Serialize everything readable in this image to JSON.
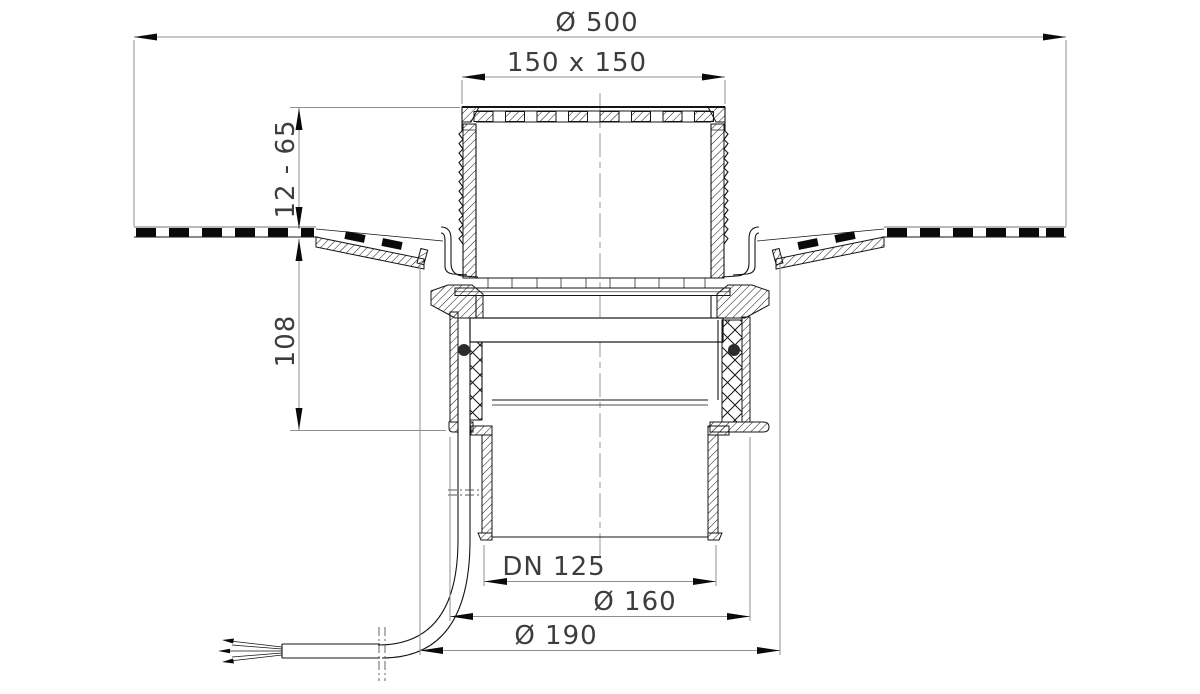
{
  "drawing": {
    "dimensions": {
      "top_diameter": "Ø 500",
      "grate_size": "150 x 150",
      "height_range": "12 - 65",
      "body_height": "108",
      "outlet_nominal": "DN 125",
      "outlet_outer": "Ø 160",
      "flange_diameter": "Ø 190"
    },
    "colors": {
      "line": "#141414",
      "dimension_line": "#8f8f8f",
      "text": "#3d3d3d",
      "background": "#ffffff"
    }
  }
}
